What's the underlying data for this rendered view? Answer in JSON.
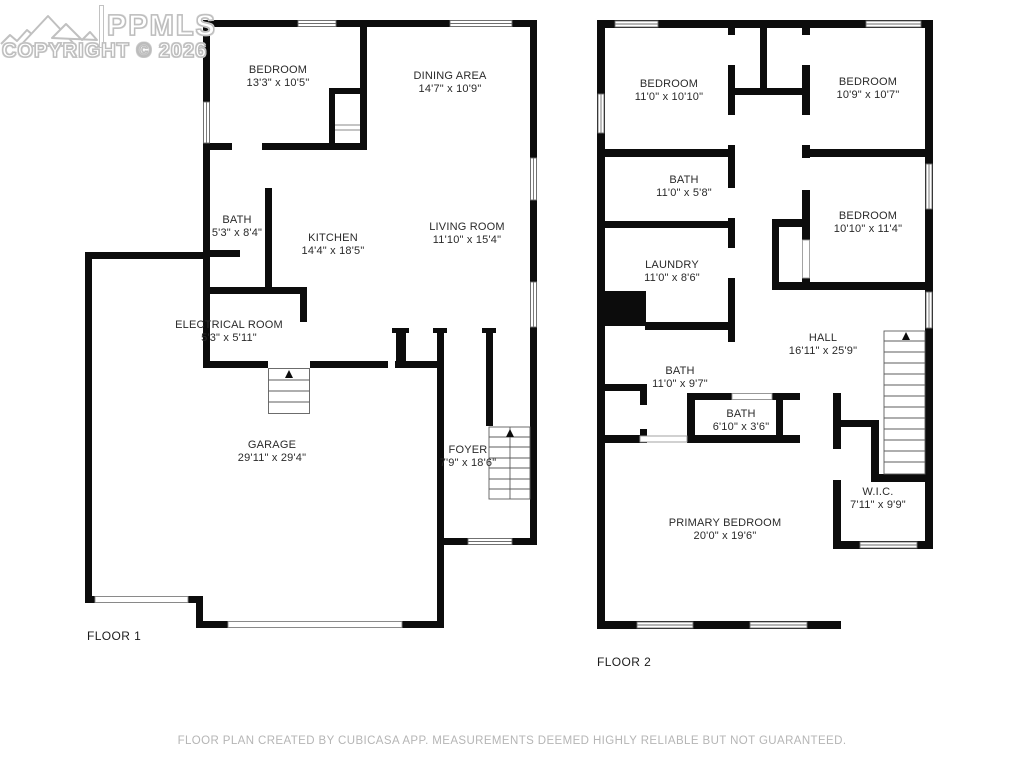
{
  "watermark": {
    "brand": "PPMLS",
    "copyright": "COPYRIGHT © 2026",
    "logo_icon": "mountain-logo-icon"
  },
  "floor1": {
    "label": "FLOOR 1",
    "rooms": [
      {
        "name": "BEDROOM",
        "dims": "13'3\" x 10'5\""
      },
      {
        "name": "DINING AREA",
        "dims": "14'7\" x 10'9\""
      },
      {
        "name": "BATH",
        "dims": "5'3\" x 8'4\""
      },
      {
        "name": "KITCHEN",
        "dims": "14'4\" x 18'5\""
      },
      {
        "name": "LIVING ROOM",
        "dims": "11'10\" x 15'4\""
      },
      {
        "name": "ELECTRICAL ROOM",
        "dims": "5'3\" x 5'11\""
      },
      {
        "name": "GARAGE",
        "dims": "29'11\" x 29'4\""
      },
      {
        "name": "FOYER",
        "dims": "7'9\" x 18'6\""
      }
    ]
  },
  "floor2": {
    "label": "FLOOR 2",
    "rooms": [
      {
        "name": "BEDROOM",
        "dims": "11'0\" x 10'10\""
      },
      {
        "name": "BEDROOM",
        "dims": "10'9\" x 10'7\""
      },
      {
        "name": "BATH",
        "dims": "11'0\" x 5'8\""
      },
      {
        "name": "BEDROOM",
        "dims": "10'10\" x 11'4\""
      },
      {
        "name": "LAUNDRY",
        "dims": "11'0\" x 8'6\""
      },
      {
        "name": "HALL",
        "dims": "16'11\" x 25'9\""
      },
      {
        "name": "BATH",
        "dims": "11'0\" x 9'7\""
      },
      {
        "name": "BATH",
        "dims": "6'10\" x 3'6\""
      },
      {
        "name": "W.I.C.",
        "dims": "7'11\" x 9'9\""
      },
      {
        "name": "PRIMARY BEDROOM",
        "dims": "20'0\" x 19'6\""
      }
    ]
  },
  "footer": {
    "text": "FLOOR PLAN CREATED BY CUBICASA APP. MEASUREMENTS DEEMED HIGHLY RELIABLE BUT NOT GUARANTEED."
  }
}
